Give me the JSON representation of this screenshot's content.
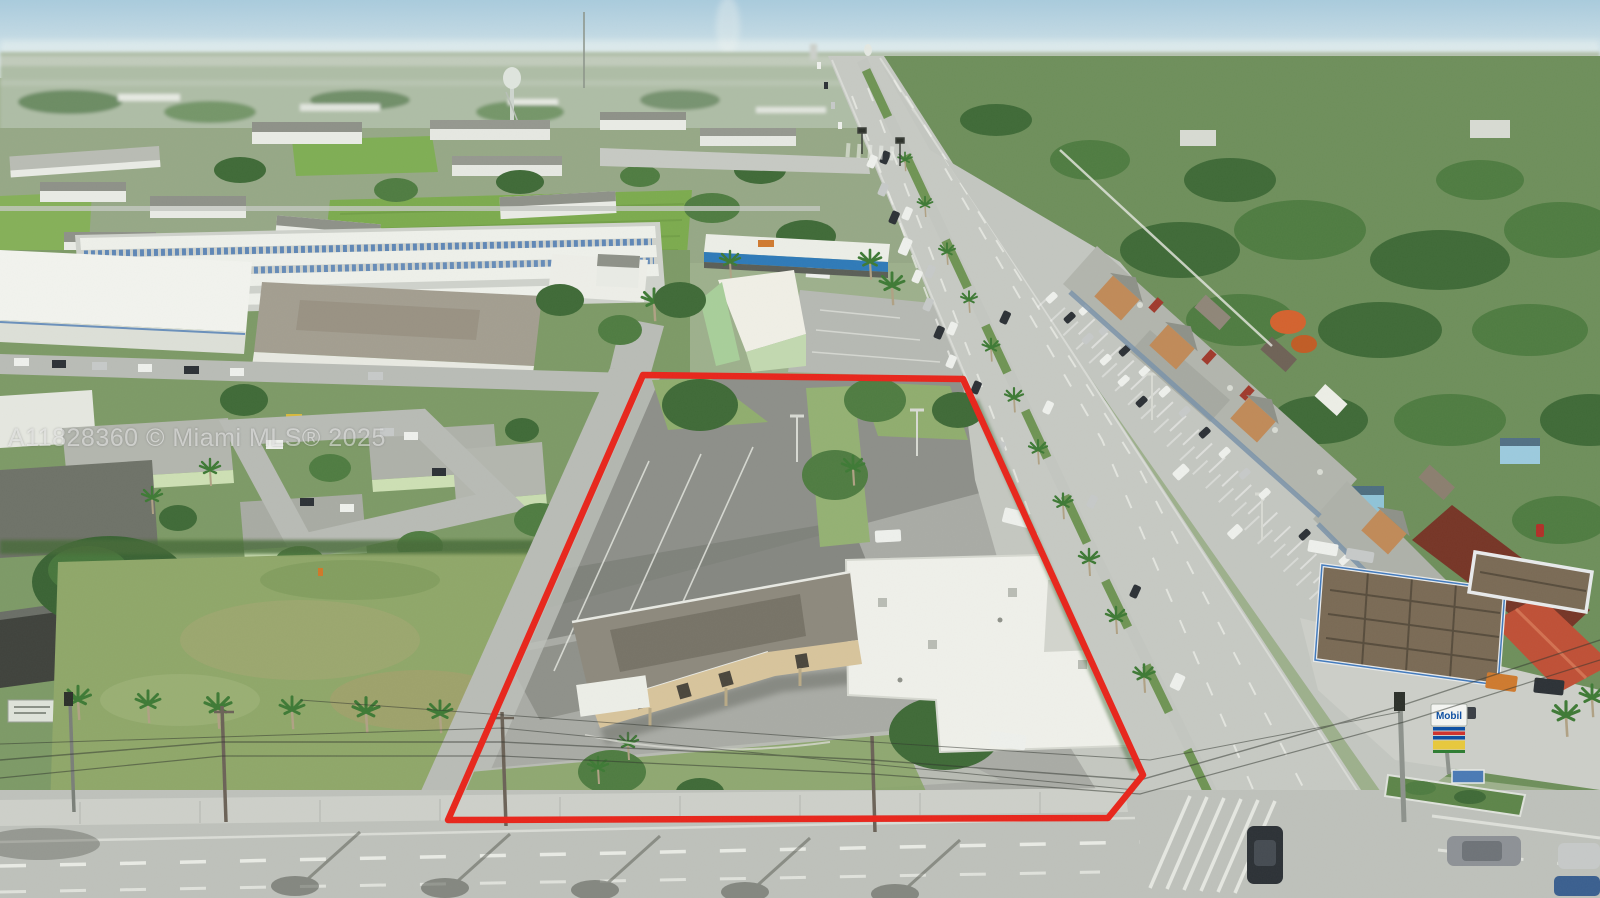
{
  "photo": {
    "kind": "aerial drone photo of commercial property listing"
  },
  "watermark": {
    "text": "A11828360 © Miami MLS® 2025",
    "color": "#ffffff",
    "opacity": 0.5
  },
  "parcel_outline": {
    "color": "#e8251b",
    "stroke_width": 6.5,
    "points": "643,375 963,379 1143,775 1108,818 448,820"
  },
  "signs": {
    "mobil_label": "Mobil",
    "mobil_blue": "#0b4ea2",
    "mobil_red": "#d0312c"
  },
  "palette": {
    "sky_top": "#a9cbdd",
    "sky_horizon": "#e6efef",
    "far_suburb": "#aebda6",
    "canopy_dark": "#3f6a37",
    "canopy_mid": "#4f7c41",
    "grass": "#8fae6d",
    "field_green": "#7cab4e",
    "road_concrete": "#c6c9c3",
    "parcel_asphalt": "#a9aba5",
    "roof_white": "#eef0ea",
    "mall_tan": "#c08a58",
    "tile_red": "#c05136",
    "storage_blue": "#3a6fb0"
  }
}
